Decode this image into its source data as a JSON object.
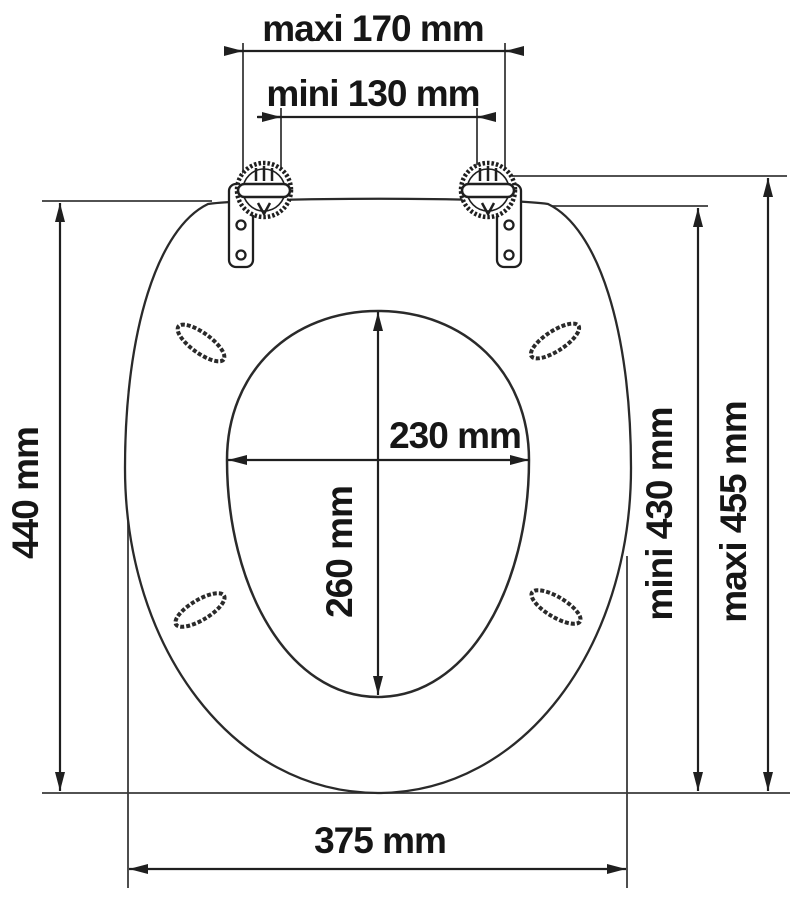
{
  "diagram": {
    "type": "technical-dimension-drawing",
    "subject": "toilet seat with hinges, top view",
    "unit": "mm",
    "colors": {
      "line": "#1f1f1f",
      "background": "#ffffff",
      "text": "#161616"
    },
    "labels": {
      "hinge_spacing_max": "maxi 170 mm",
      "hinge_spacing_min": "mini 130 mm",
      "opening_width": "230 mm",
      "opening_depth": "260 mm",
      "seat_length": "440 mm",
      "overall_length_min": "mini 430 mm",
      "overall_length_max": "maxi 455 mm",
      "seat_width": "375 mm"
    },
    "values_mm": {
      "hinge_spacing_max": 170,
      "hinge_spacing_min": 130,
      "opening_width": 230,
      "opening_depth": 260,
      "seat_length": 440,
      "overall_length_min": 430,
      "overall_length_max": 455,
      "seat_width": 375
    }
  }
}
